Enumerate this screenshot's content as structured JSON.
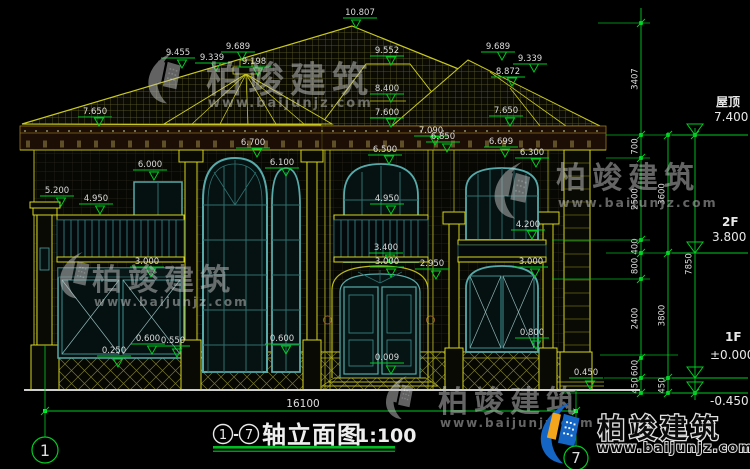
{
  "drawing": {
    "title_bubble_left": "1",
    "title_dash": "-",
    "title_bubble_right": "7",
    "title_name": "轴立面图",
    "title_scale": "1:100",
    "overall_dimension": "16100",
    "grid_bubble_left": "1",
    "grid_bubble_right": "7"
  },
  "levels": [
    {
      "name": "屋顶",
      "value": "7.400"
    },
    {
      "name": "2F",
      "value": "3.800"
    },
    {
      "name": "1F",
      "value": "±0.000"
    },
    {
      "name": "",
      "value": "-0.450"
    }
  ],
  "dim_chains": {
    "chain_a": [
      "3407",
      "700",
      "2500",
      "400",
      "800",
      "2400",
      "600",
      "450"
    ],
    "chain_b": [
      "3600",
      "3800",
      "450"
    ],
    "chain_c": [
      "7850"
    ]
  },
  "annotations": [
    {
      "t": "10.807",
      "x": 360,
      "y": 15,
      "ax": 356,
      "ay": 28
    },
    {
      "t": "9.455",
      "x": 178,
      "y": 55,
      "ax": 182,
      "ay": 68
    },
    {
      "t": "9.689",
      "x": 238,
      "y": 49,
      "ax": 242,
      "ay": 60
    },
    {
      "t": "9.339",
      "x": 212,
      "y": 60,
      "ax": 216,
      "ay": 71
    },
    {
      "t": "9.198",
      "x": 254,
      "y": 64,
      "ax": 258,
      "ay": 76
    },
    {
      "t": "9.552",
      "x": 387,
      "y": 53,
      "ax": 391,
      "ay": 65
    },
    {
      "t": "8.400",
      "x": 387,
      "y": 91,
      "ax": 391,
      "ay": 102
    },
    {
      "t": "7.600",
      "x": 387,
      "y": 115,
      "ax": 391,
      "ay": 127
    },
    {
      "t": "7.650",
      "x": 95,
      "y": 114,
      "ax": 99,
      "ay": 126
    },
    {
      "t": "9.689",
      "x": 498,
      "y": 49,
      "ax": 502,
      "ay": 60
    },
    {
      "t": "9.339",
      "x": 530,
      "y": 61,
      "ax": 534,
      "ay": 72
    },
    {
      "t": "8.872",
      "x": 508,
      "y": 74,
      "ax": 512,
      "ay": 86
    },
    {
      "t": "7.650",
      "x": 506,
      "y": 113,
      "ax": 510,
      "ay": 126
    },
    {
      "t": "7.090",
      "x": 431,
      "y": 133,
      "ax": 435,
      "ay": 145
    },
    {
      "t": "6.850",
      "x": 443,
      "y": 139,
      "ax": 447,
      "ay": 152
    },
    {
      "t": "6.699",
      "x": 501,
      "y": 144,
      "ax": 505,
      "ay": 157
    },
    {
      "t": "6.300",
      "x": 532,
      "y": 155,
      "ax": 536,
      "ay": 167
    },
    {
      "t": "6.700",
      "x": 253,
      "y": 145,
      "ax": 257,
      "ay": 157
    },
    {
      "t": "6.100",
      "x": 282,
      "y": 165,
      "ax": 286,
      "ay": 176
    },
    {
      "t": "6.000",
      "x": 150,
      "y": 167,
      "ax": 154,
      "ay": 180
    },
    {
      "t": "6.500",
      "x": 385,
      "y": 152,
      "ax": 389,
      "ay": 164
    },
    {
      "t": "5.200",
      "x": 57,
      "y": 193,
      "ax": 61,
      "ay": 206
    },
    {
      "t": "4.950",
      "x": 96,
      "y": 201,
      "ax": 100,
      "ay": 214
    },
    {
      "t": "4.950",
      "x": 387,
      "y": 201,
      "ax": 391,
      "ay": 214
    },
    {
      "t": "4.200",
      "x": 528,
      "y": 227,
      "ax": 532,
      "ay": 239
    },
    {
      "t": "3.400",
      "x": 386,
      "y": 250,
      "ax": 390,
      "ay": 263
    },
    {
      "t": "3.000",
      "x": 387,
      "y": 264,
      "ax": 391,
      "ay": 277
    },
    {
      "t": "2.950",
      "x": 432,
      "y": 266,
      "ax": 436,
      "ay": 279
    },
    {
      "t": "3.000",
      "x": 147,
      "y": 264,
      "ax": 151,
      "ay": 277
    },
    {
      "t": "3.000",
      "x": 531,
      "y": 264,
      "ax": 535,
      "ay": 277
    },
    {
      "t": "0.800",
      "x": 532,
      "y": 335,
      "ax": 536,
      "ay": 349
    },
    {
      "t": "0.600",
      "x": 148,
      "y": 341,
      "ax": 152,
      "ay": 354
    },
    {
      "t": "0.550",
      "x": 173,
      "y": 343,
      "ax": 177,
      "ay": 357
    },
    {
      "t": "0.250",
      "x": 114,
      "y": 353,
      "ax": 118,
      "ay": 367
    },
    {
      "t": "0.600",
      "x": 282,
      "y": 341,
      "ax": 286,
      "ay": 354
    },
    {
      "t": "0.009",
      "x": 387,
      "y": 360,
      "ax": 391,
      "ay": 374
    },
    {
      "t": "0.450",
      "x": 586,
      "y": 375,
      "ax": 590,
      "ay": 389
    }
  ],
  "watermark": {
    "brand": "柏竣建筑",
    "url": "www.baijunjz.com"
  },
  "colors": {
    "dimension_green": "#00cc22",
    "line_yellow": "#b9b91c",
    "column_yellow": "#d6d61e",
    "window_teal": "#57aaaa",
    "text_white": "#dcdcdc",
    "logo_blue": "#1565c4",
    "logo_orange": "#f5a51c"
  }
}
